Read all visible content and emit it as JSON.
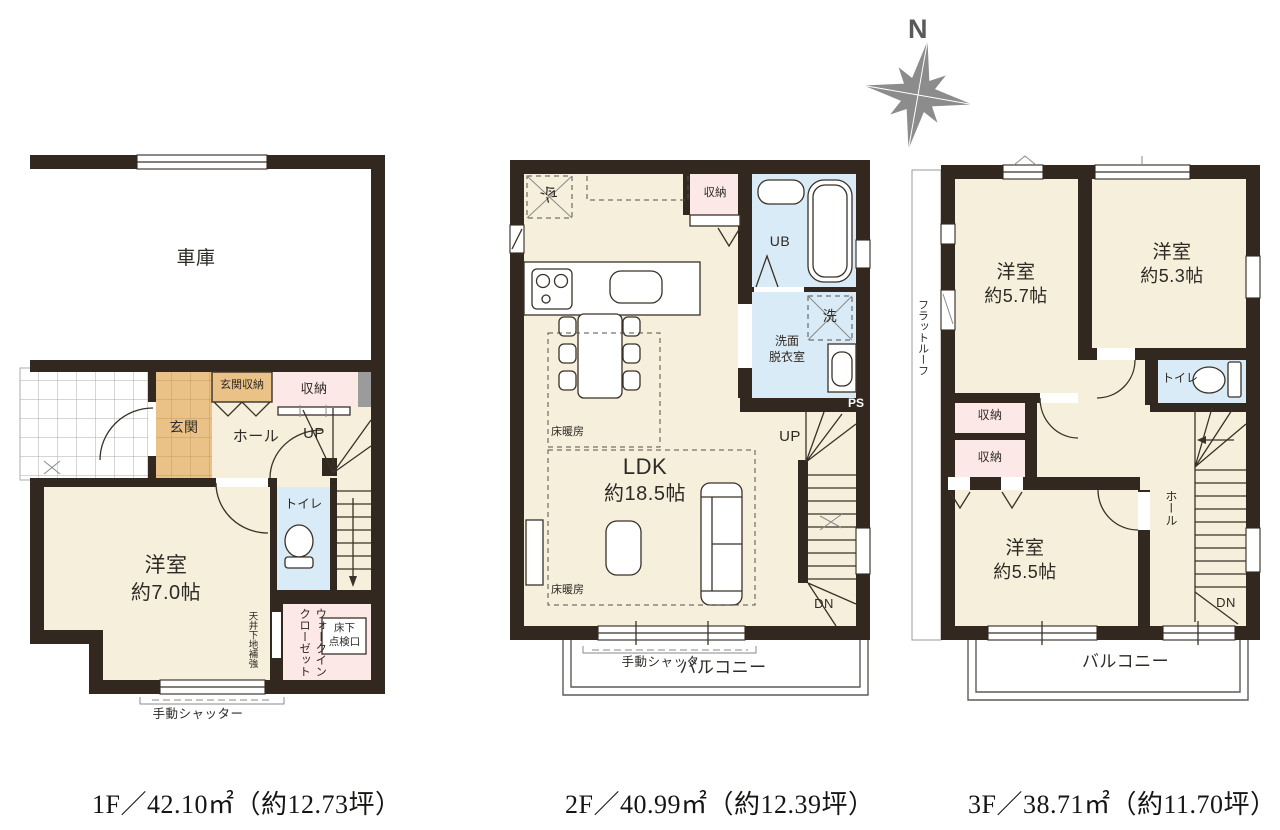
{
  "compass": {
    "north": "N"
  },
  "f1": {
    "caption": "1F／42.10㎡（約12.73坪）",
    "garage": "車庫",
    "genkan": "玄関",
    "genkan_storage": "玄関収納",
    "storage": "収納",
    "hall": "ホール",
    "up": "UP",
    "toilet": "トイレ",
    "room_label": "洋室",
    "room_size": "約7.0帖",
    "wic_line1": "ウォークイン",
    "wic_line2": "クローゼット",
    "ceiling_note": "天井下地補強",
    "hatch_line1": "床下",
    "hatch_line2": "点検口",
    "shutter": "手動シャッター"
  },
  "f2": {
    "caption": "2F／40.99㎡（約12.39坪）",
    "fridge": "冷",
    "storage": "収納",
    "unit_bath": "UB",
    "laundry": "洗",
    "washroom_line1": "洗面",
    "washroom_line2": "脱衣室",
    "ps": "PS",
    "up": "UP",
    "dn": "DN",
    "floor_heating": "床暖房",
    "ldk_label": "LDK",
    "ldk_size": "約18.5帖",
    "shutter": "手動シャッター",
    "balcony": "バルコニー"
  },
  "f3": {
    "caption": "3F／38.71㎡（約11.70坪）",
    "flat_roof": "フラットルーフ",
    "room_a_label": "洋室",
    "room_a_size": "約5.7帖",
    "room_b_label": "洋室",
    "room_b_size": "約5.3帖",
    "room_c_label": "洋室",
    "room_c_size": "約5.5帖",
    "toilet": "トイレ",
    "storage_a": "収納",
    "storage_b": "収納",
    "hall": "ホール",
    "dn": "DN",
    "balcony": "バルコニー"
  },
  "colors": {
    "wall": "#32281f",
    "room_cream": "#f6efdb",
    "entry_tan": "#eac288",
    "storage_pink": "#fce8e6",
    "wet_blue": "#d9ebf6",
    "block_gray": "#9b9b9b",
    "outline": "#3a3128",
    "compass_gray": "#8c8c8c"
  }
}
